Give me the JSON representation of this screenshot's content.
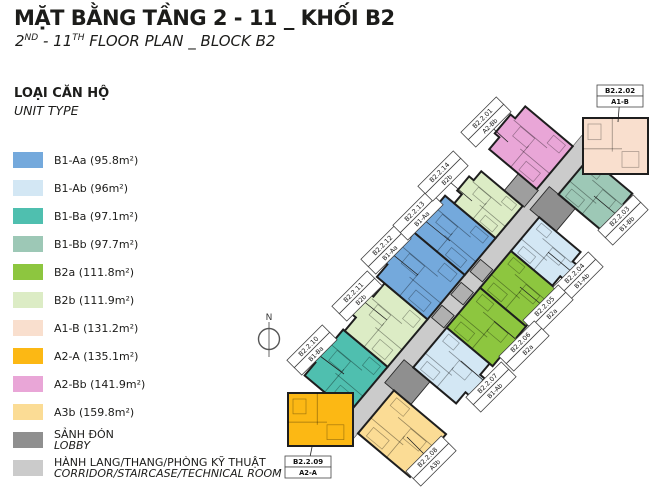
{
  "title": {
    "vi": "MẶT BẰNG TẦNG 2 - 11 _ KHỐI B2",
    "en_parts": [
      "2",
      "ND",
      " - 11",
      "TH",
      " FLOOR PLAN _ BLOCK B2"
    ]
  },
  "legend": {
    "title_vi": "LOẠI CĂN HỘ",
    "title_en": "UNIT TYPE",
    "units": [
      {
        "code": "B1-Aa",
        "area_label": "(95.8m²)",
        "color": "#74A9DC"
      },
      {
        "code": "B1-Ab",
        "area_label": "(96m²)",
        "color": "#D3E7F4"
      },
      {
        "code": "B1-Ba",
        "area_label": "(97.1m²)",
        "color": "#4FBFAF"
      },
      {
        "code": "B1-Bb",
        "area_label": "(97.7m²)",
        "color": "#9DC8B6"
      },
      {
        "code": "B2a",
        "area_label": "(111.8m²)",
        "color": "#8DC63F"
      },
      {
        "code": "B2b",
        "area_label": "(111.9m²)",
        "color": "#DCECC5"
      },
      {
        "code": "A1-B",
        "area_label": "(131.2m²)",
        "color": "#F9DFCE"
      },
      {
        "code": "A2-A",
        "area_label": "(135.1m²)",
        "color": "#FCB814"
      },
      {
        "code": "A2-Bb",
        "area_label": "(141.9m²)",
        "color": "#E9A6D7"
      },
      {
        "code": "A3b",
        "area_label": "(159.8m²)",
        "color": "#FBDC95"
      }
    ],
    "areas": [
      {
        "vi": "SẢNH ĐÓN",
        "en": "LOBBY",
        "color": "#8F8F8F"
      },
      {
        "vi": "HÀNH LANG/THANG/PHÒNG KỸ THUẬT",
        "en": "CORRIDOR/STAIRCASE/TECHNICAL ROOM",
        "color": "#CBCBCB"
      }
    ]
  },
  "plan": {
    "north_label": "N",
    "units": [
      {
        "id": "B2.2.01",
        "type": "A2-Bb"
      },
      {
        "id": "B2.2.02",
        "type": "A1-B"
      },
      {
        "id": "B2.2.03",
        "type": "B1-Bb"
      },
      {
        "id": "B2.2.04",
        "type": "B1-Ab"
      },
      {
        "id": "B2.2.05",
        "type": "B2a"
      },
      {
        "id": "B2.2.06",
        "type": "B2a"
      },
      {
        "id": "B2.2.07",
        "type": "B1-Ab"
      },
      {
        "id": "B2.2.08",
        "type": "A3b"
      },
      {
        "id": "B2.2.09",
        "type": "A2-A"
      },
      {
        "id": "B2.2.10",
        "type": "B1-Ba"
      },
      {
        "id": "B2.2.11",
        "type": "B2b"
      },
      {
        "id": "B2.2.12",
        "type": "B1-Aa"
      },
      {
        "id": "B2.2.13",
        "type": "B1-Aa"
      },
      {
        "id": "B2.2.14",
        "type": "B2b"
      }
    ]
  }
}
